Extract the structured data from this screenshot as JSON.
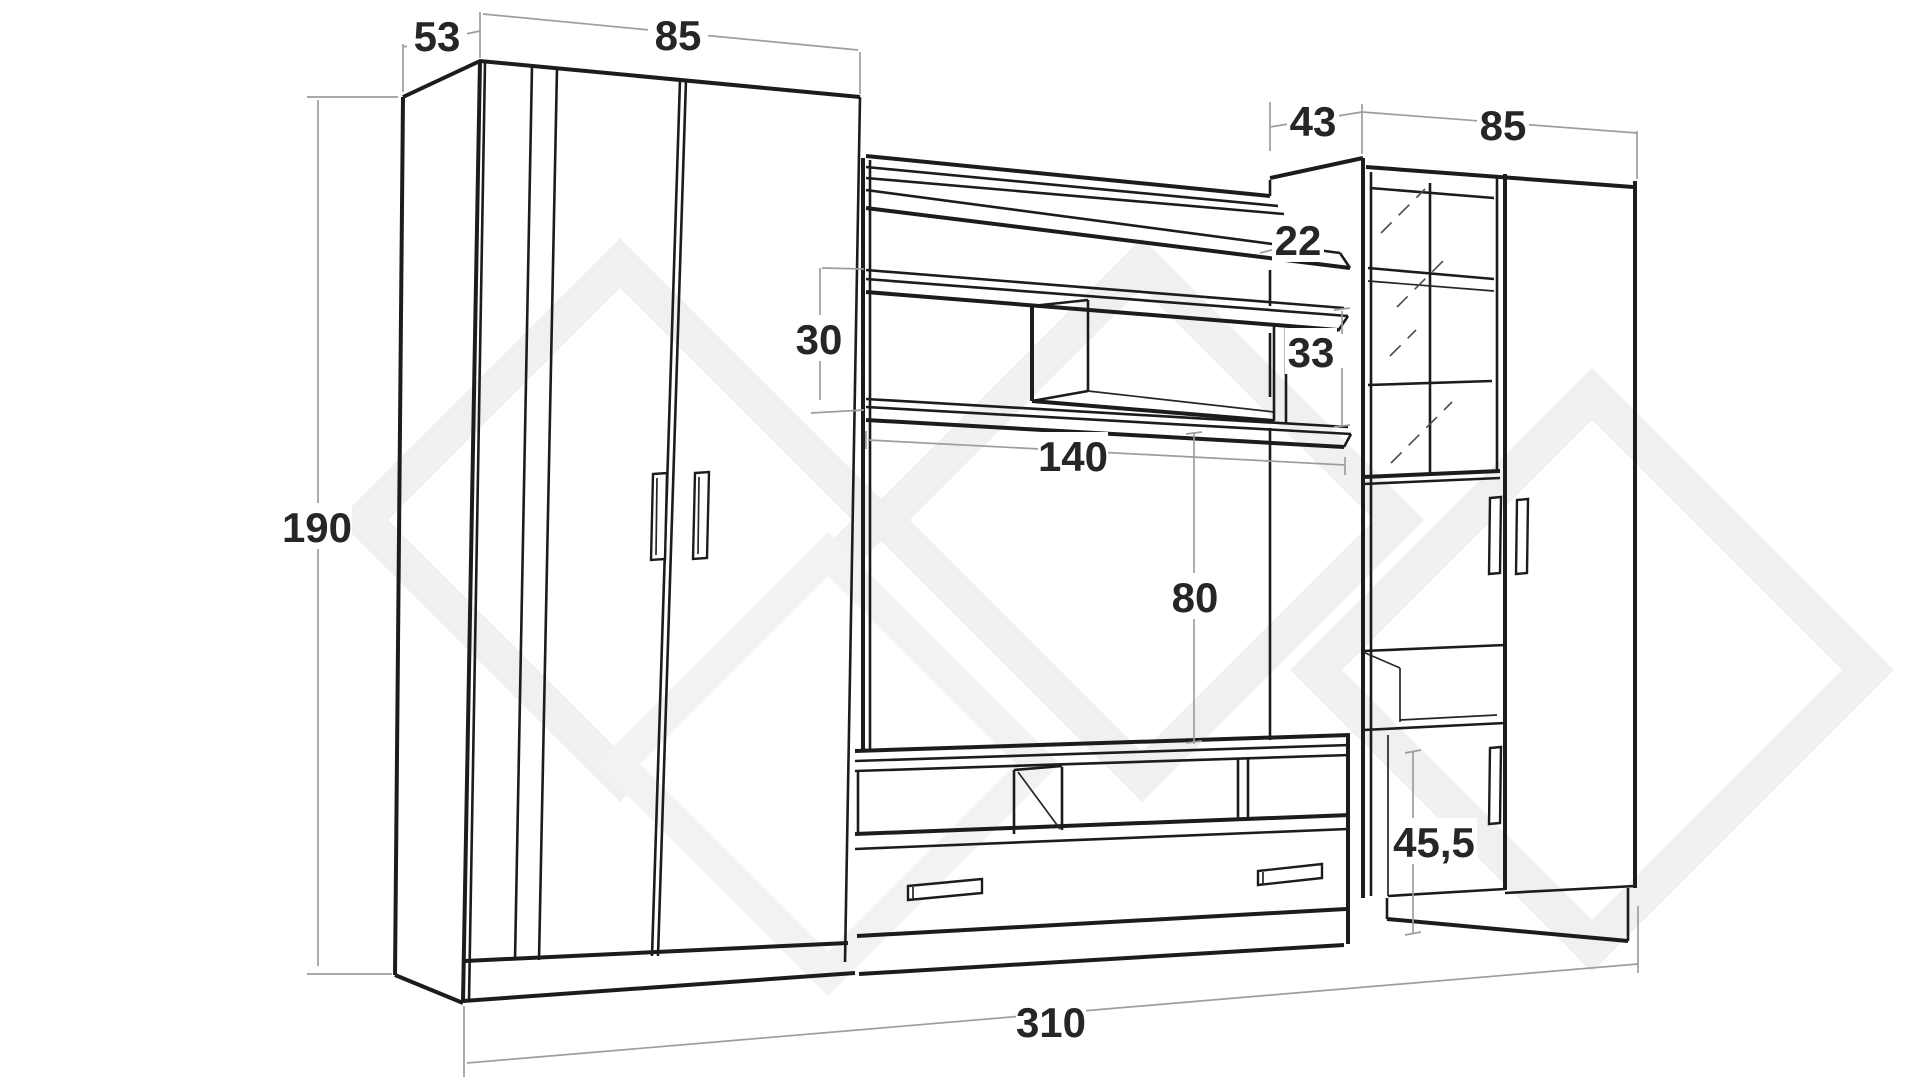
{
  "diagram": {
    "title": "furniture wall unit dimension drawing",
    "unit": "cm",
    "dimensions": {
      "wardrobe_depth": "53",
      "wardrobe_width": "85",
      "total_height": "190",
      "shelf_gap_left": "30",
      "tv_niche_width": "140",
      "tv_niche_height": "80",
      "top_shelf_height": "22",
      "shelf_gap_right": "33",
      "cabinet_depth": "43",
      "cabinet_width": "85",
      "base_section_height": "45,5",
      "total_width": "310"
    },
    "colors": {
      "line": "#1c1c1c",
      "dimension_line": "#9d9d9d",
      "watermark": "#f0f0f0",
      "background": "#ffffff"
    }
  }
}
